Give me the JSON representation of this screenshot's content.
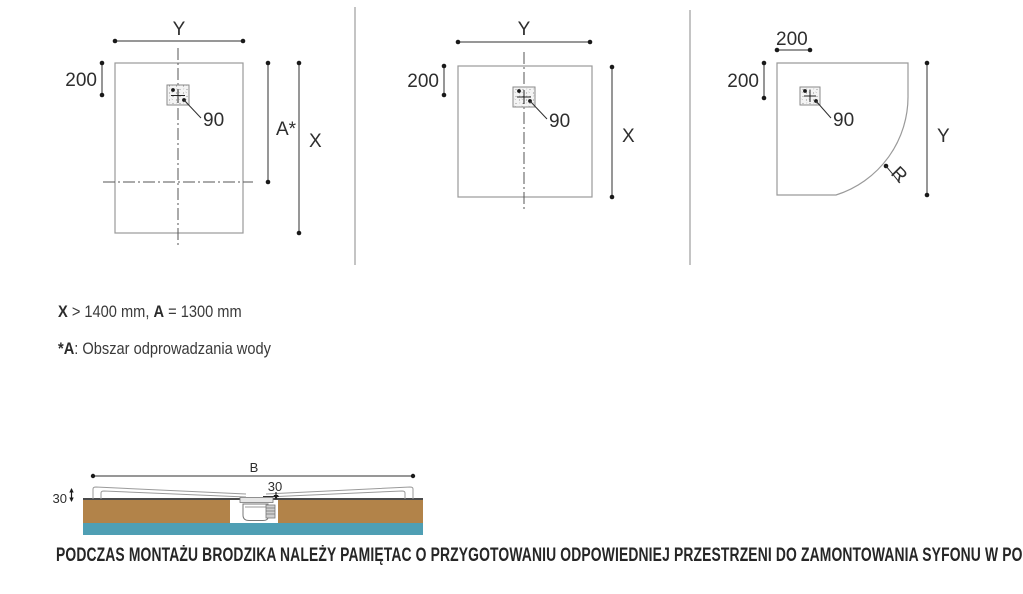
{
  "drawings": {
    "rect_tray": {
      "width_label": "Y",
      "offset_label": "200",
      "drain_label": "90",
      "drain_area_label": "A*",
      "length_label": "X"
    },
    "square_tray": {
      "width_label": "Y",
      "offset_label": "200",
      "drain_label": "90",
      "length_label": "X"
    },
    "quadrant_tray": {
      "top_offset_label": "200",
      "side_offset_label": "200",
      "drain_label": "90",
      "side_label": "Y",
      "radius_label": "R"
    },
    "cross_section": {
      "width_label": "B",
      "thickness_label": "30",
      "recess_label": "30"
    }
  },
  "notes": {
    "dimension_spec": {
      "x_bold": "X",
      "x_rest": " > 1400 mm, ",
      "a_bold": "A",
      "a_rest": " = 1300 mm"
    },
    "drain_area": {
      "bold": "*A",
      "rest": ": Obszar odprowadzania wody"
    }
  },
  "warning": {
    "text": "PODCZAS MONTAŻU BRODZIKA NALEŻY PAMIĘTAC O PRZYGOTOWANIU ODPOWIEDNIEJ PRZESTRZENI DO ZAMONTOWANIA SYFONU W PODŁODZE."
  },
  "colors": {
    "floor_brown": "#b28349",
    "screed_blue": "#4f9fb4",
    "outline_gray": "#9a9a9a",
    "dimension_dark": "#2f2f2f"
  }
}
